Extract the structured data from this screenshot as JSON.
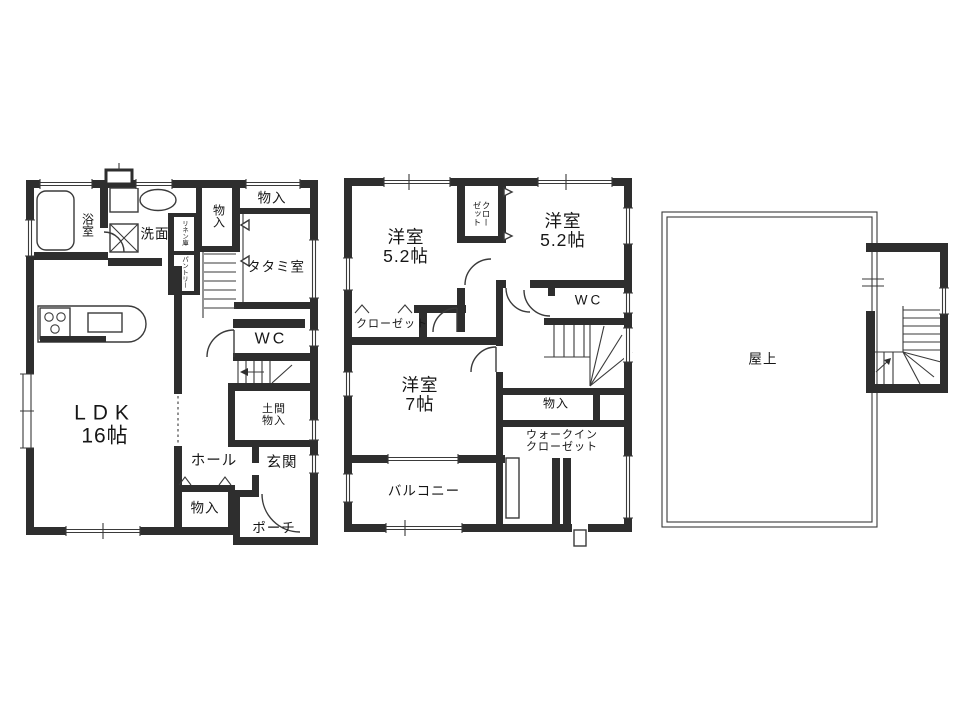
{
  "colors": {
    "wall": "#2e2e2e",
    "line": "#3a3a3a",
    "background": "#ffffff"
  },
  "floor1": {
    "bath": "浴室",
    "washroom": "洗面",
    "linen_closet": "リネン庫",
    "pantry": "パントリー",
    "closet_upper": "物入",
    "closet_top_right": "物入",
    "tatami_room": "タタミ室",
    "wc": "WC",
    "ldk_line1": "LDK",
    "ldk_line2": "16帖",
    "doma_line1": "土間",
    "doma_line2": "物入",
    "hall": "ホール",
    "entrance": "玄関",
    "closet_hall": "物入",
    "porch": "ポーチ"
  },
  "floor2": {
    "bedroom_left_line1": "洋室",
    "bedroom_left_line2": "5.2帖",
    "closet_center_line1": "クロー",
    "closet_center_line2": "ゼット",
    "bedroom_right_line1": "洋室",
    "bedroom_right_line2": "5.2帖",
    "wc": "WC",
    "closet_left": "クローゼット",
    "bedroom_main_line1": "洋室",
    "bedroom_main_line2": "7帖",
    "storage": "物入",
    "wic_line1": "ウォークイン",
    "wic_line2": "クローゼット",
    "balcony": "バルコニー"
  },
  "roof": {
    "rooftop": "屋上"
  }
}
